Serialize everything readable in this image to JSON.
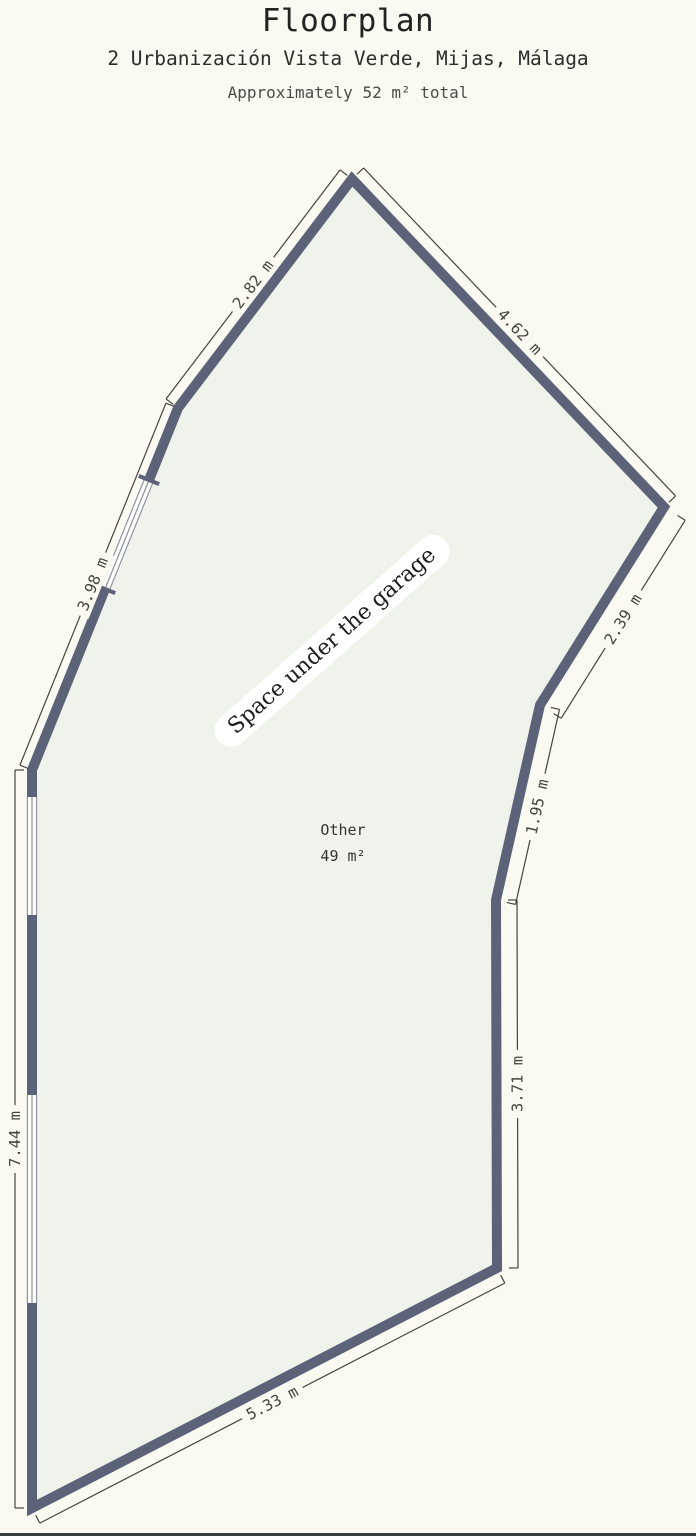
{
  "header": {
    "title": "Floorplan",
    "address": "2 Urbanización Vista Verde, Mijas, Málaga",
    "approx": "Approximately 52 m² total"
  },
  "room": {
    "banner": "Space under the garage",
    "name": "Other",
    "area": "49 m²"
  },
  "colors": {
    "background": "#faf9f2",
    "floor": "#f0f2ec",
    "wall": "#5c6278",
    "dimension": "#45453f",
    "window_fill": "#fcfcf9",
    "window_line": "#8d93a2",
    "banner_bg": "#ffffff",
    "bottom_border": "#3a3e45"
  },
  "floorplan": {
    "wall_thickness": 10,
    "polygon": [
      [
        352,
        179
      ],
      [
        664,
        507
      ],
      [
        540,
        705
      ],
      [
        496,
        900
      ],
      [
        497,
        1268
      ],
      [
        32,
        1508
      ],
      [
        32,
        770
      ],
      [
        178,
        408
      ]
    ],
    "windows": [
      {
        "p1": [
          149,
          480
        ],
        "p2": [
          105,
          589
        ],
        "caps": true
      },
      {
        "p1": [
          32,
          797
        ],
        "p2": [
          32,
          915
        ],
        "caps": false
      },
      {
        "p1": [
          32,
          1095
        ],
        "p2": [
          32,
          1303
        ],
        "caps": false
      }
    ],
    "dimensions": [
      {
        "label": "2.82 m",
        "p1": [
          352,
          179
        ],
        "p2": [
          178,
          408
        ],
        "side": "cw",
        "offset": 15,
        "angle": -52.8
      },
      {
        "label": "4.62 m",
        "p1": [
          352,
          179
        ],
        "p2": [
          664,
          507
        ],
        "side": "ccw",
        "offset": 16,
        "angle": 46.4
      },
      {
        "label": "2.39 m",
        "p1": [
          664,
          507
        ],
        "p2": [
          540,
          705
        ],
        "side": "ccw",
        "offset": 25,
        "angle": -58
      },
      {
        "label": "1.95 m",
        "p1": [
          540,
          705
        ],
        "p2": [
          496,
          900
        ],
        "side": "ccw",
        "offset": 20,
        "angle": -77.3
      },
      {
        "label": "3.71 m",
        "p1": [
          496,
          900
        ],
        "p2": [
          497,
          1268
        ],
        "side": "ccw",
        "offset": 21,
        "angle": -90
      },
      {
        "label": "5.33 m",
        "p1": [
          32,
          1508
        ],
        "p2": [
          497,
          1268
        ],
        "side": "cw",
        "offset": 17,
        "angle": -27.3
      },
      {
        "label": "7.44 m",
        "p1": [
          32,
          770
        ],
        "p2": [
          32,
          1508
        ],
        "side": "cw",
        "offset": 17,
        "angle": -90
      },
      {
        "label": "3.98 m",
        "p1": [
          178,
          408
        ],
        "p2": [
          32,
          770
        ],
        "side": "cw",
        "offset": 13,
        "angle": -67.9
      }
    ],
    "banner_pos": {
      "x": 332,
      "y": 641,
      "angle": -41.5
    },
    "room_label_pos": {
      "x": 343,
      "y": 843
    }
  }
}
